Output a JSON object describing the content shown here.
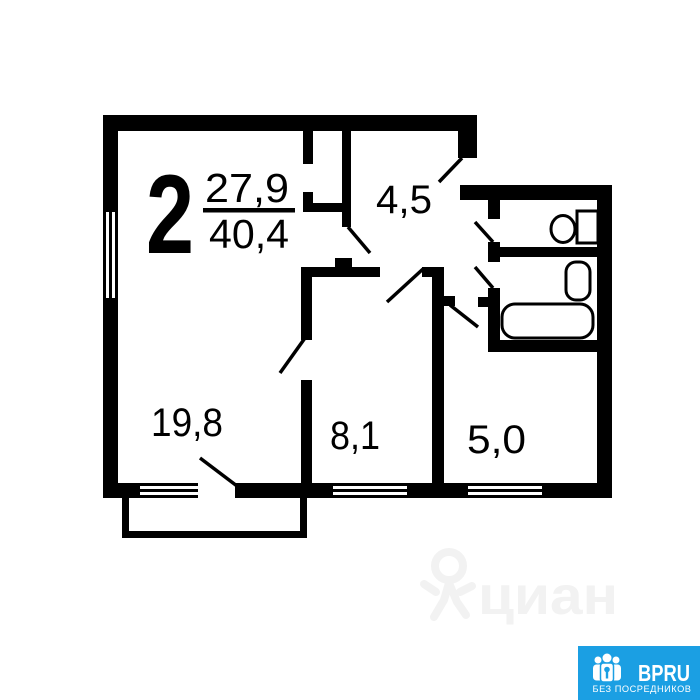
{
  "plan": {
    "rooms_count": "2",
    "living_area": "27,9",
    "total_area": "40,4",
    "areas": {
      "hall": "4,5",
      "room1": "19,8",
      "room2": "8,1",
      "room3": "5,0"
    },
    "colors": {
      "walls": "#000000",
      "background": "#ffffff"
    }
  },
  "watermark": {
    "text": "циан",
    "icon": "cian-pin-logo",
    "color": "#f2f2f2"
  },
  "badge": {
    "title": "BPRU",
    "subtitle": "БЕЗ ПОСРЕДНИКОВ",
    "icon": "people-key-icon",
    "bg_color": "#1b9fe3",
    "text_color": "#ffffff"
  }
}
